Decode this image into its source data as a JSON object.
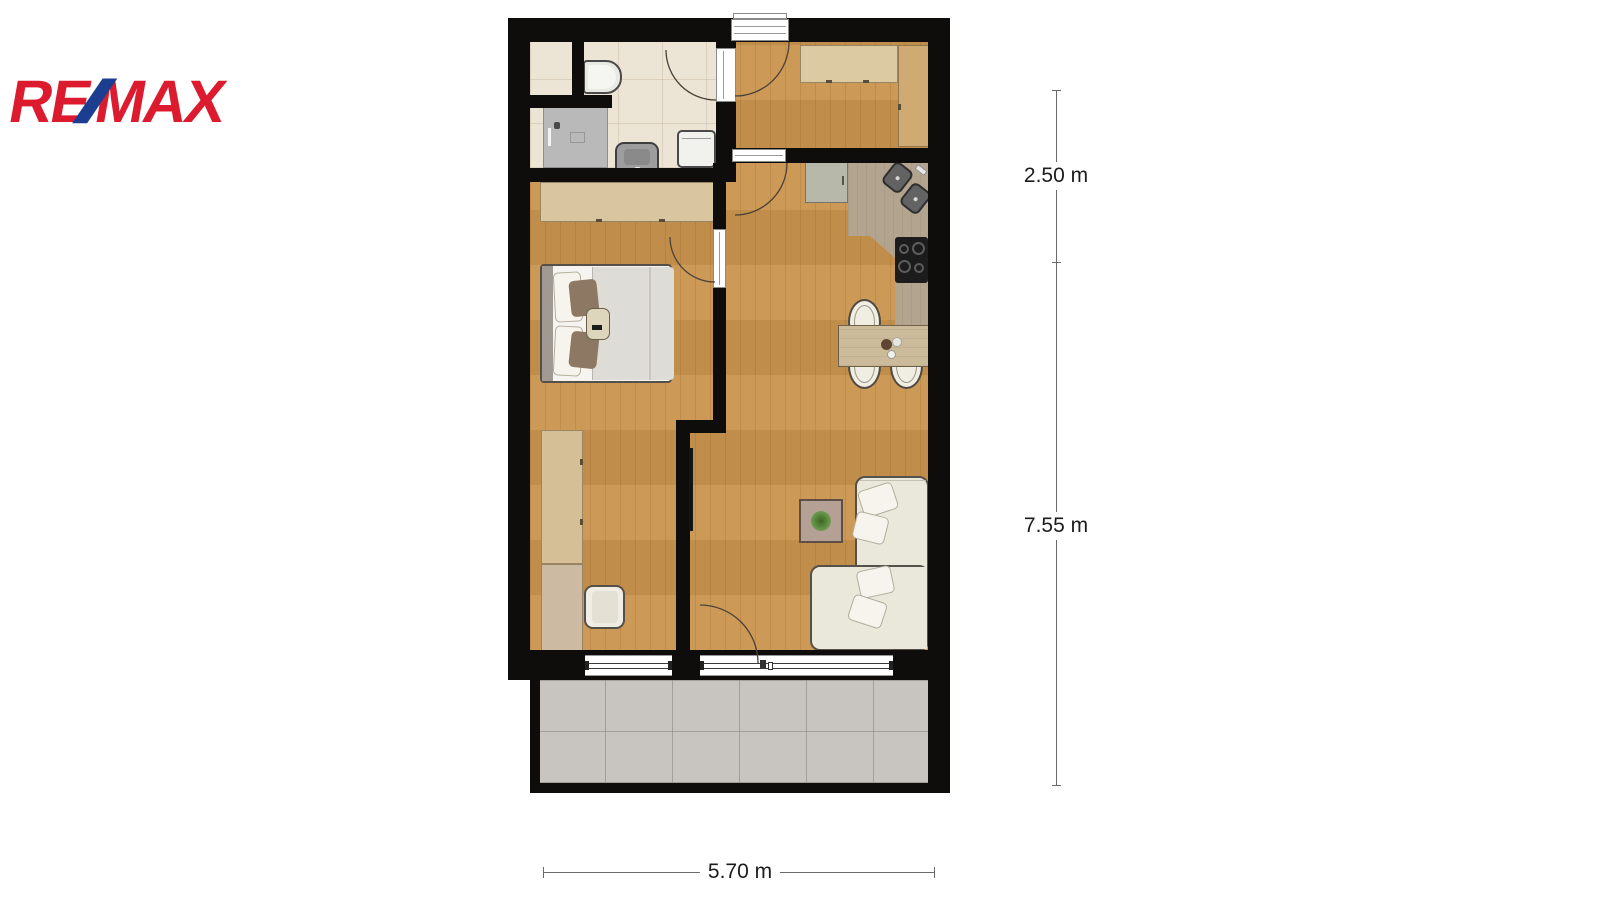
{
  "logo": {
    "re": "RE",
    "slash": "/",
    "max": "MAX"
  },
  "dimensions": {
    "vertical_top": "2.50 m",
    "vertical_bottom": "7.55 m",
    "horizontal": "5.70 m"
  },
  "colors": {
    "remax_red": "#dc1c2e",
    "remax_blue": "#1b3e90",
    "wall": "#0e0d0b",
    "wood_floor": "#c9944f",
    "bathroom_floor": "#ece4d5",
    "terrace_tile": "#c8c5c0",
    "kitchen_counter": "#b3a48f",
    "kitchen_cabinet": "#b8b8aa",
    "sofa": "#eae7db",
    "dimension_text": "#1c1c1c"
  }
}
